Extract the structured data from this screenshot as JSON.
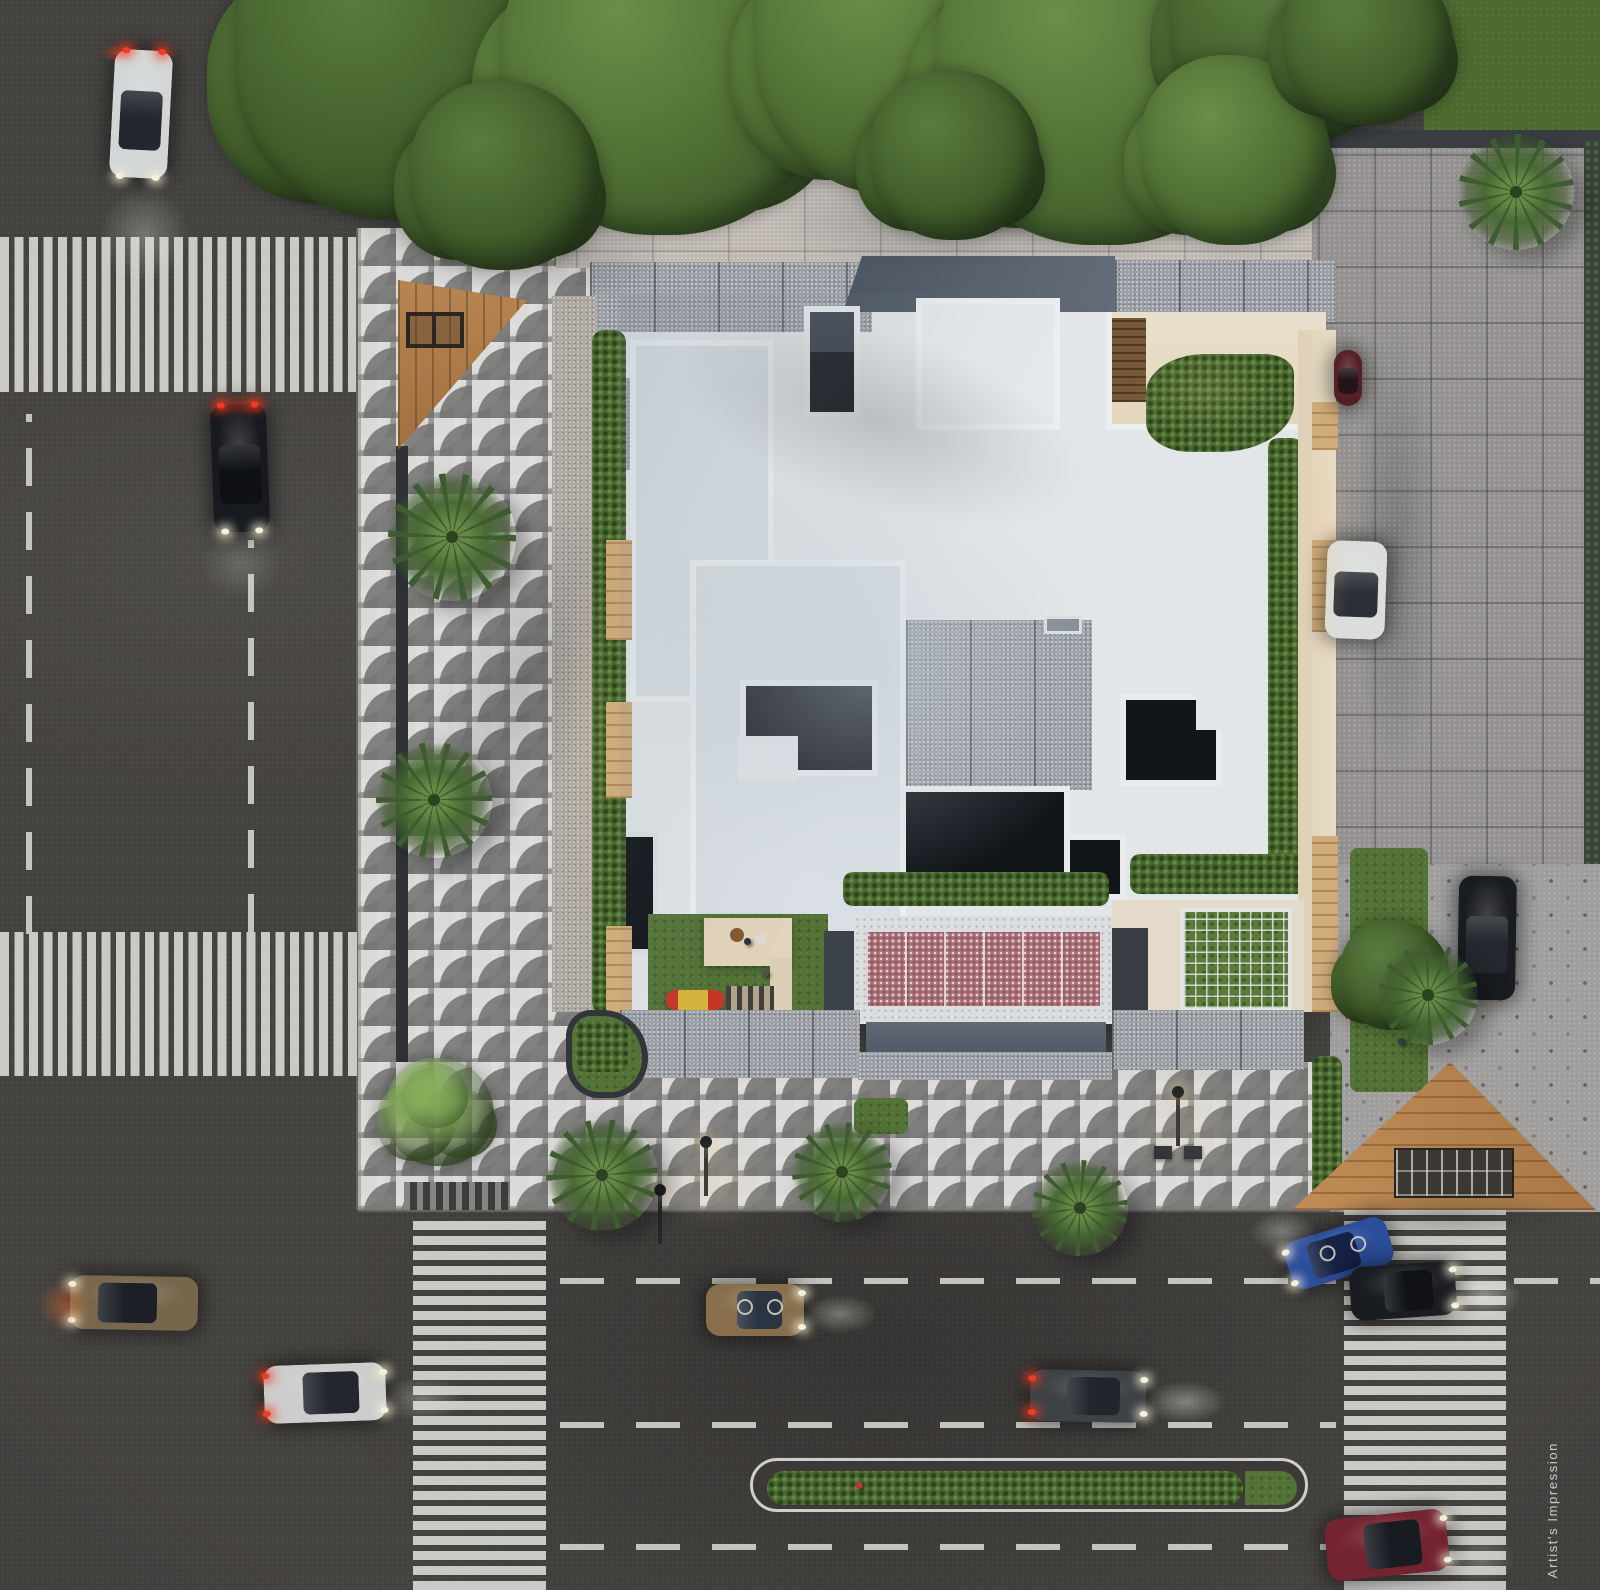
{
  "meta": {
    "scene_type": "aerial-architectural-render",
    "time_of_day": "dusk",
    "watermark": "Artist's Impression"
  },
  "palette": {
    "asphalt": "#46433f",
    "plaza_tile": "#cbcac7",
    "concrete_roof": "#a3a7ac",
    "roof_white": "#edf0f1",
    "slate_band": "#5c6470",
    "terrace_cream": "#f0e2c8",
    "pool_canopy_pink": "#b0737a",
    "wood_deck": "#c08a52",
    "lawn_green": "#567635",
    "hedge_green": "#4b6c2f",
    "crosswalk_paint": "#d8d9d3"
  },
  "scene": {
    "cars": [
      {
        "name": "white-hatchback-north-road",
        "x": 112,
        "y": 50,
        "w": 58,
        "h": 128,
        "rot": 3,
        "body": "#dcdfdf",
        "glass": "#23272e",
        "front": "S",
        "tail": true,
        "lights": true,
        "decals": false
      },
      {
        "name": "black-sedan-north-road",
        "x": 212,
        "y": 404,
        "w": 56,
        "h": 128,
        "rot": -2,
        "body": "#17191d",
        "glass": "#0d0f13",
        "front": "S",
        "tail": true,
        "lights": true,
        "decals": false
      },
      {
        "name": "gold-suv-intersection",
        "x": 70,
        "y": 1276,
        "w": 128,
        "h": 54,
        "rot": 1,
        "body": "#7b6a4e",
        "glass": "#1c2025",
        "front": "W",
        "tail": false,
        "lights": true,
        "decals": false
      },
      {
        "name": "silver-sedan-intersection",
        "x": 264,
        "y": 1364,
        "w": 122,
        "h": 58,
        "rot": -2,
        "body": "#d5d6d4",
        "glass": "#23262b",
        "front": "E",
        "tail": true,
        "lights": true,
        "decals": false
      },
      {
        "name": "bronze-sedan-avenue",
        "x": 706,
        "y": 1284,
        "w": 98,
        "h": 52,
        "rot": 0,
        "body": "#8d724d",
        "glass": "#2a3542",
        "front": "E",
        "tail": false,
        "lights": true,
        "decals": true
      },
      {
        "name": "gray-sedan-avenue",
        "x": 1030,
        "y": 1370,
        "w": 116,
        "h": 52,
        "rot": 1,
        "body": "#3f4347",
        "glass": "#22252a",
        "front": "E",
        "tail": true,
        "lights": true,
        "decals": false
      },
      {
        "name": "blue-sedan-crosswalk",
        "x": 1286,
        "y": 1228,
        "w": 106,
        "h": 50,
        "rot": -17,
        "body": "#2c4f9f",
        "glass": "#152147",
        "front": "W",
        "tail": false,
        "lights": true,
        "decals": true
      },
      {
        "name": "black-sedan-crosswalk",
        "x": 1350,
        "y": 1264,
        "w": 106,
        "h": 54,
        "rot": -4,
        "body": "#1a1c20",
        "glass": "#0f1115",
        "front": "E",
        "tail": false,
        "lights": true,
        "decals": false
      },
      {
        "name": "red-sedan-avenue",
        "x": 1326,
        "y": 1514,
        "w": 122,
        "h": 62,
        "rot": -6,
        "body": "#7a2330",
        "glass": "#181b20",
        "front": "E",
        "tail": false,
        "lights": true,
        "decals": false
      },
      {
        "name": "white-car-parked",
        "x": 1326,
        "y": 541,
        "w": 60,
        "h": 98,
        "rot": 2,
        "body": "#e5e7e5",
        "glass": "#2c3036",
        "front": "S",
        "tail": false,
        "lights": false,
        "decals": false
      },
      {
        "name": "maroon-car-parked",
        "x": 1334,
        "y": 350,
        "w": 28,
        "h": 56,
        "rot": 0,
        "body": "#571f26",
        "glass": "#241317",
        "front": "S",
        "tail": false,
        "lights": false,
        "decals": false
      },
      {
        "name": "black-suv-parked",
        "x": 1458,
        "y": 876,
        "w": 58,
        "h": 124,
        "rot": 1,
        "body": "#191b1e",
        "glass": "#25282d",
        "front": "S",
        "tail": false,
        "lights": false,
        "decals": false
      }
    ],
    "trees": [
      {
        "cx": 400,
        "cy": 55,
        "r": 165,
        "tone": "dark"
      },
      {
        "cx": 665,
        "cy": 70,
        "r": 165,
        "tone": "main"
      },
      {
        "cx": 905,
        "cy": 45,
        "r": 150,
        "tone": "main"
      },
      {
        "cx": 1105,
        "cy": 75,
        "r": 170,
        "tone": "main"
      },
      {
        "cx": 1290,
        "cy": 25,
        "r": 120,
        "tone": "dark"
      },
      {
        "cx": 505,
        "cy": 175,
        "r": 95,
        "tone": "dark"
      },
      {
        "cx": 955,
        "cy": 155,
        "r": 85,
        "tone": "dark"
      },
      {
        "cx": 1235,
        "cy": 150,
        "r": 95,
        "tone": "main"
      },
      {
        "cx": 1368,
        "cy": 40,
        "r": 85,
        "tone": "dark"
      },
      {
        "cx": 440,
        "cy": 1112,
        "r": 54,
        "tone": "bright"
      },
      {
        "cx": 1395,
        "cy": 975,
        "r": 55,
        "tone": "dark"
      }
    ],
    "palms": [
      {
        "cx": 452,
        "cy": 537,
        "r": 64
      },
      {
        "cx": 434,
        "cy": 800,
        "r": 58
      },
      {
        "cx": 602,
        "cy": 1175,
        "r": 56
      },
      {
        "cx": 842,
        "cy": 1172,
        "r": 50
      },
      {
        "cx": 1080,
        "cy": 1208,
        "r": 48
      },
      {
        "cx": 1516,
        "cy": 192,
        "r": 58
      },
      {
        "cx": 1428,
        "cy": 995,
        "r": 50
      }
    ],
    "shades": [
      {
        "x": 250,
        "y": 120,
        "w": 480,
        "h": 200,
        "rot": 14,
        "o": 0.3
      },
      {
        "x": 700,
        "y": 120,
        "w": 560,
        "h": 170,
        "rot": -6,
        "o": 0.28
      },
      {
        "x": 420,
        "y": 420,
        "w": 210,
        "h": 520,
        "rot": 22,
        "o": 0.16
      },
      {
        "x": 600,
        "y": 300,
        "w": 560,
        "h": 240,
        "rot": 18,
        "o": 0.16
      },
      {
        "x": 1336,
        "y": 240,
        "w": 120,
        "h": 620,
        "rot": 0,
        "o": 0.2
      },
      {
        "x": 1290,
        "y": 1180,
        "w": 320,
        "h": 70,
        "rot": 0,
        "o": 0.25
      },
      {
        "x": 380,
        "y": 1080,
        "w": 140,
        "h": 70,
        "rot": 0,
        "o": 0.2
      }
    ],
    "glows": [
      {
        "x": 84,
        "y": 170,
        "w": 120,
        "h": 130,
        "c": "rgba(240,244,240,0.30)"
      },
      {
        "x": 96,
        "y": 40,
        "w": 40,
        "h": 26,
        "c": "rgba(255,70,40,0.45)"
      },
      {
        "x": 200,
        "y": 390,
        "w": 80,
        "h": 30,
        "c": "rgba(255,60,30,0.40)"
      },
      {
        "x": 186,
        "y": 520,
        "w": 110,
        "h": 90,
        "c": "rgba(240,244,240,0.18)"
      },
      {
        "x": 30,
        "y": 1270,
        "w": 70,
        "h": 70,
        "c": "rgba(255,120,50,0.45)"
      },
      {
        "x": 368,
        "y": 1368,
        "w": 110,
        "h": 62,
        "c": "rgba(242,243,235,0.30)"
      },
      {
        "x": 790,
        "y": 1288,
        "w": 100,
        "h": 52,
        "c": "rgba(244,243,230,0.35)"
      },
      {
        "x": 1130,
        "y": 1374,
        "w": 110,
        "h": 56,
        "c": "rgba(244,244,235,0.40)"
      },
      {
        "x": 1434,
        "y": 1266,
        "w": 100,
        "h": 60,
        "c": "rgba(246,246,240,0.45)"
      },
      {
        "x": 1238,
        "y": 1204,
        "w": 90,
        "h": 56,
        "c": "rgba(246,246,240,0.35)"
      },
      {
        "x": 1436,
        "y": 1528,
        "w": 90,
        "h": 64,
        "c": "rgba(242,242,232,0.28)"
      },
      {
        "x": 640,
        "y": 1118,
        "w": 150,
        "h": 130,
        "c": "rgba(255,228,160,0.14)"
      },
      {
        "x": 1110,
        "y": 1062,
        "w": 150,
        "h": 130,
        "c": "rgba(255,228,160,0.12)"
      },
      {
        "x": 1290,
        "y": 360,
        "w": 70,
        "h": 360,
        "c": "rgba(255,212,140,0.20)"
      },
      {
        "x": 1100,
        "y": 330,
        "w": 210,
        "h": 120,
        "c": "rgba(255,216,150,0.16)"
      },
      {
        "x": 560,
        "y": 430,
        "w": 60,
        "h": 600,
        "c": "rgba(255,220,160,0.10)"
      }
    ],
    "lamps": [
      {
        "x": 706,
        "y": 1144
      },
      {
        "x": 1178,
        "y": 1094
      },
      {
        "x": 660,
        "y": 1192
      }
    ],
    "utility_boxes": [
      {
        "x": 1154,
        "y": 1146,
        "w": 18,
        "h": 13
      },
      {
        "x": 1184,
        "y": 1146,
        "w": 18,
        "h": 13
      }
    ],
    "figures": [
      {
        "x": 744,
        "y": 938,
        "c": "#2f2f33"
      },
      {
        "x": 762,
        "y": 970,
        "c": "#55524c"
      },
      {
        "x": 856,
        "y": 1482,
        "c": "#c33a2c"
      },
      {
        "x": 1398,
        "y": 1038,
        "c": "#3e4448"
      }
    ]
  }
}
